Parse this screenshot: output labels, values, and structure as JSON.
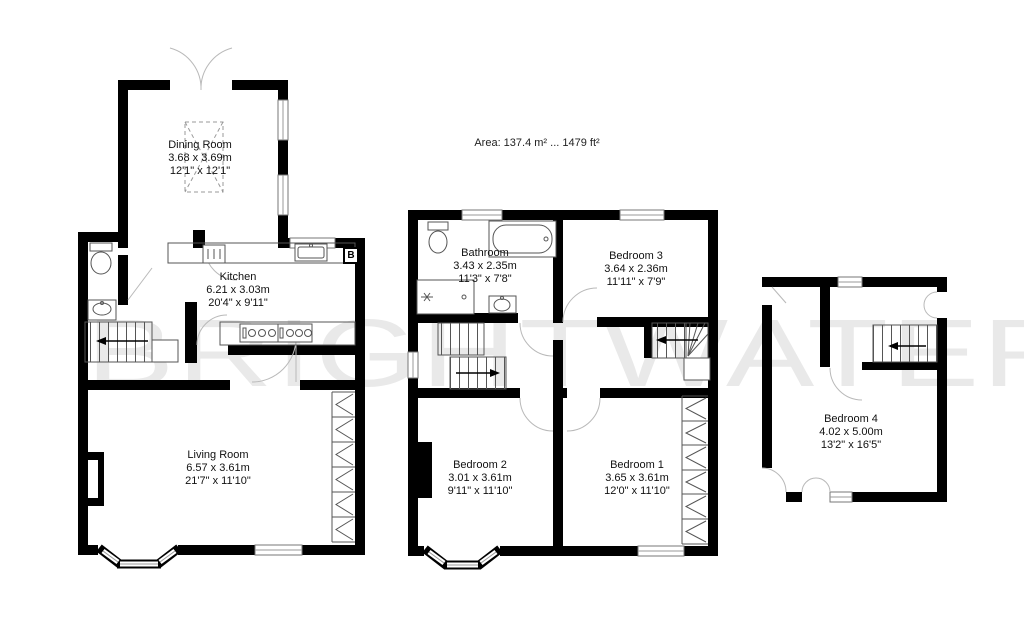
{
  "area_label": "Area: 137.4 m² ... 1479 ft²",
  "watermark": "BRIGHTWATER",
  "boiler_label": "B",
  "rooms": {
    "dining": {
      "name": "Dining Room",
      "metric": "3.68 x 3.69m",
      "imperial": "12'1\" x 12'1\""
    },
    "kitchen": {
      "name": "Kitchen",
      "metric": "6.21 x 3.03m",
      "imperial": "20'4\" x 9'11\""
    },
    "living": {
      "name": "Living Room",
      "metric": "6.57 x 3.61m",
      "imperial": "21'7\" x 11'10\""
    },
    "bathroom": {
      "name": "Bathroom",
      "metric": "3.43 x 2.35m",
      "imperial": "11'3\" x 7'8\""
    },
    "bedroom3": {
      "name": "Bedroom 3",
      "metric": "3.64 x 2.36m",
      "imperial": "11'11\" x 7'9\""
    },
    "bedroom2": {
      "name": "Bedroom 2",
      "metric": "3.01 x 3.61m",
      "imperial": "9'11\" x 11'10\""
    },
    "bedroom1": {
      "name": "Bedroom 1",
      "metric": "3.65 x 3.61m",
      "imperial": "12'0\" x 11'10\""
    },
    "bedroom4": {
      "name": "Bedroom 4",
      "metric": "4.02 x 5.00m",
      "imperial": "13'2\" x 16'5\""
    }
  }
}
